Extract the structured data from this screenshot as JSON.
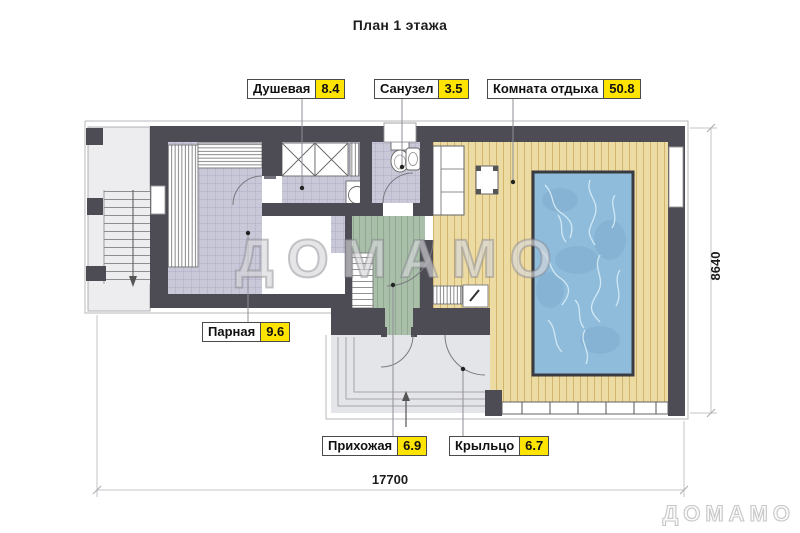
{
  "title": "План 1 этажа",
  "rooms": {
    "shower": {
      "name": "Душевая",
      "area": "8.4"
    },
    "wc": {
      "name": "Санузел",
      "area": "3.5"
    },
    "lounge": {
      "name": "Комната отдыха",
      "area": "50.8"
    },
    "steam": {
      "name": "Парная",
      "area": "9.6"
    },
    "hall": {
      "name": "Прихожая",
      "area": "6.9"
    },
    "porch": {
      "name": "Крыльцо",
      "area": "6.7"
    }
  },
  "dimensions": {
    "width": "17700",
    "height": "8640"
  },
  "watermark": {
    "center": "ДОМАМО",
    "corner": "ДОМАМО"
  },
  "colors": {
    "wall": "#4d4c54",
    "area_highlight": "#ffe400",
    "tile_floor": "#c9c8d9",
    "wood_floor": "#ecdba3",
    "hall_floor": "#a9bfa9",
    "porch_floor": "#e4e5e8",
    "pool_water": "#8fbcdb"
  }
}
